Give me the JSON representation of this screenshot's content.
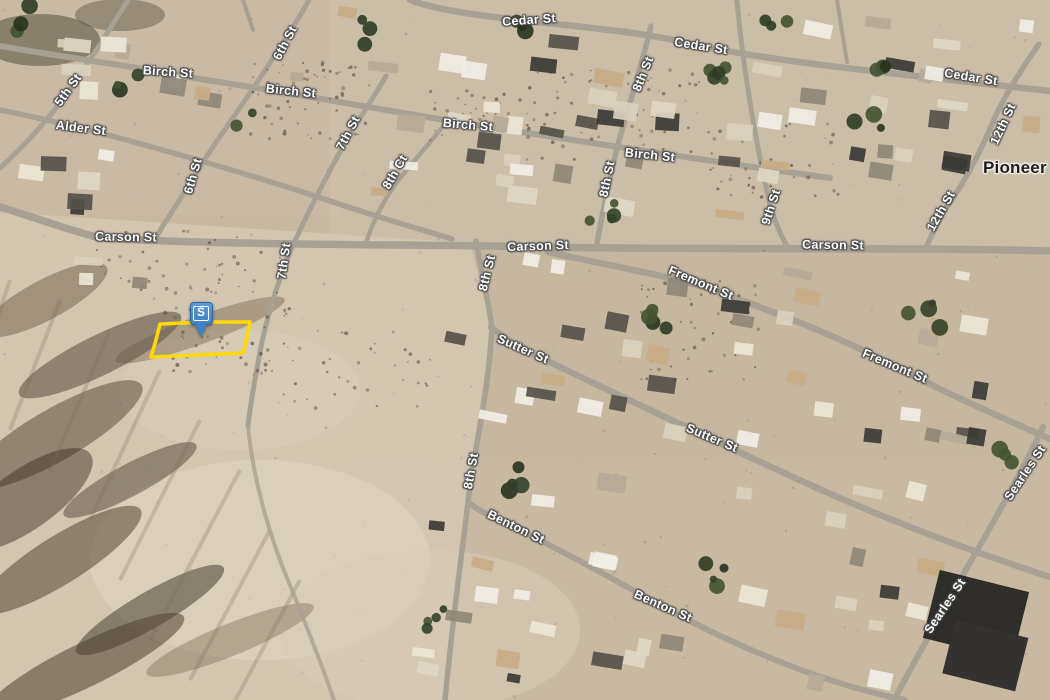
{
  "map": {
    "view": "satellite-aerial",
    "marker": {
      "label": "S",
      "color": "#3f81c4",
      "tip_x": 201,
      "tip_y": 337
    },
    "parcel_outline": {
      "color": "#ffd900",
      "points": [
        [
          160,
          324
        ],
        [
          205,
          322
        ],
        [
          250,
          322
        ],
        [
          247,
          337
        ],
        [
          243,
          353
        ],
        [
          199,
          355
        ],
        [
          151,
          357
        ],
        [
          156,
          340
        ]
      ]
    },
    "place_labels": [
      {
        "text": "Pioneer Point",
        "x": 983,
        "y": 168,
        "r": 0
      }
    ],
    "street_labels": [
      {
        "text": "Cedar St",
        "x": 529,
        "y": 20,
        "r": -4
      },
      {
        "text": "Cedar St",
        "x": 701,
        "y": 46,
        "r": 9
      },
      {
        "text": "Cedar St",
        "x": 971,
        "y": 77,
        "r": 9
      },
      {
        "text": "Birch St",
        "x": 168,
        "y": 72,
        "r": 4
      },
      {
        "text": "Birch St",
        "x": 291,
        "y": 91,
        "r": 6
      },
      {
        "text": "Birch St",
        "x": 468,
        "y": 125,
        "r": 5
      },
      {
        "text": "Birch St",
        "x": 650,
        "y": 155,
        "r": 6
      },
      {
        "text": "Alder St",
        "x": 81,
        "y": 128,
        "r": 7
      },
      {
        "text": "Carson St",
        "x": 126,
        "y": 237,
        "r": 1
      },
      {
        "text": "Carson St",
        "x": 538,
        "y": 246,
        "r": -2
      },
      {
        "text": "Carson St",
        "x": 833,
        "y": 245,
        "r": 1
      },
      {
        "text": "Fremont St",
        "x": 701,
        "y": 283,
        "r": 23
      },
      {
        "text": "Fremont St",
        "x": 895,
        "y": 366,
        "r": 23
      },
      {
        "text": "Sutter St",
        "x": 523,
        "y": 349,
        "r": 24
      },
      {
        "text": "Sutter St",
        "x": 712,
        "y": 438,
        "r": 23
      },
      {
        "text": "Benton St",
        "x": 516,
        "y": 527,
        "r": 26
      },
      {
        "text": "Benton St",
        "x": 663,
        "y": 606,
        "r": 24
      },
      {
        "text": "5th St",
        "x": 68,
        "y": 90,
        "r": -54
      },
      {
        "text": "6th St",
        "x": 285,
        "y": 43,
        "r": -62
      },
      {
        "text": "6th St",
        "x": 193,
        "y": 176,
        "r": -74
      },
      {
        "text": "7th St",
        "x": 348,
        "y": 133,
        "r": -62
      },
      {
        "text": "7th St",
        "x": 284,
        "y": 261,
        "r": -82
      },
      {
        "text": "8th Ct",
        "x": 395,
        "y": 172,
        "r": -60
      },
      {
        "text": "8th St",
        "x": 643,
        "y": 74,
        "r": -68
      },
      {
        "text": "8th St",
        "x": 607,
        "y": 179,
        "r": -78
      },
      {
        "text": "8th St",
        "x": 487,
        "y": 273,
        "r": -76
      },
      {
        "text": "8th St",
        "x": 471,
        "y": 471,
        "r": -80
      },
      {
        "text": "9th St",
        "x": 771,
        "y": 207,
        "r": -72
      },
      {
        "text": "12th St",
        "x": 1003,
        "y": 124,
        "r": -65
      },
      {
        "text": "12th St",
        "x": 941,
        "y": 211,
        "r": -60
      },
      {
        "text": "Searles St",
        "x": 1025,
        "y": 473,
        "r": -56
      },
      {
        "text": "Searles St",
        "x": 945,
        "y": 606,
        "r": -56
      }
    ]
  }
}
